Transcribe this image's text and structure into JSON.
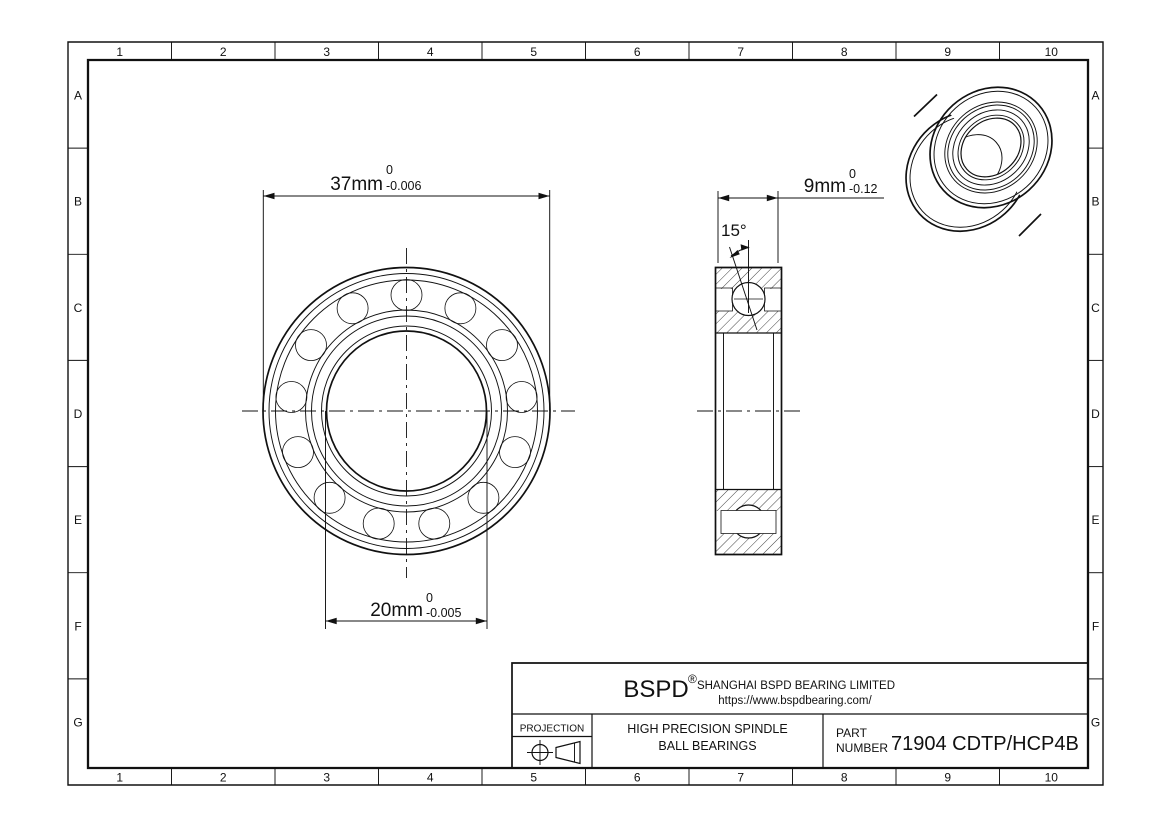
{
  "frame": {
    "columns": [
      "1",
      "2",
      "3",
      "4",
      "5",
      "6",
      "7",
      "8",
      "9",
      "10"
    ],
    "rows": [
      "A",
      "B",
      "C",
      "D",
      "E",
      "F",
      "G"
    ]
  },
  "dimensions": {
    "outer_diameter": {
      "value": "37mm",
      "tol_upper": "0",
      "tol_lower": "-0.006"
    },
    "bore_diameter": {
      "value": "20mm",
      "tol_upper": "0",
      "tol_lower": "-0.005"
    },
    "width": {
      "value": "9mm",
      "tol_upper": "0",
      "tol_lower": "-0.12"
    },
    "contact_angle": "15°"
  },
  "title_block": {
    "brand": "BSPD",
    "registered_mark": "®",
    "company": "SHANGHAI BSPD BEARING LIMITED",
    "website": "https://www.bspdbearing.com/",
    "projection_label": "PROJECTION",
    "product_line1": "HIGH PRECISION SPINDLE",
    "product_line2": "BALL BEARINGS",
    "part_label_line1": "PART",
    "part_label_line2": "NUMBER",
    "part_number": "71904 CDTP/HCP4B"
  },
  "colors": {
    "line": "#111111",
    "background": "#ffffff"
  }
}
